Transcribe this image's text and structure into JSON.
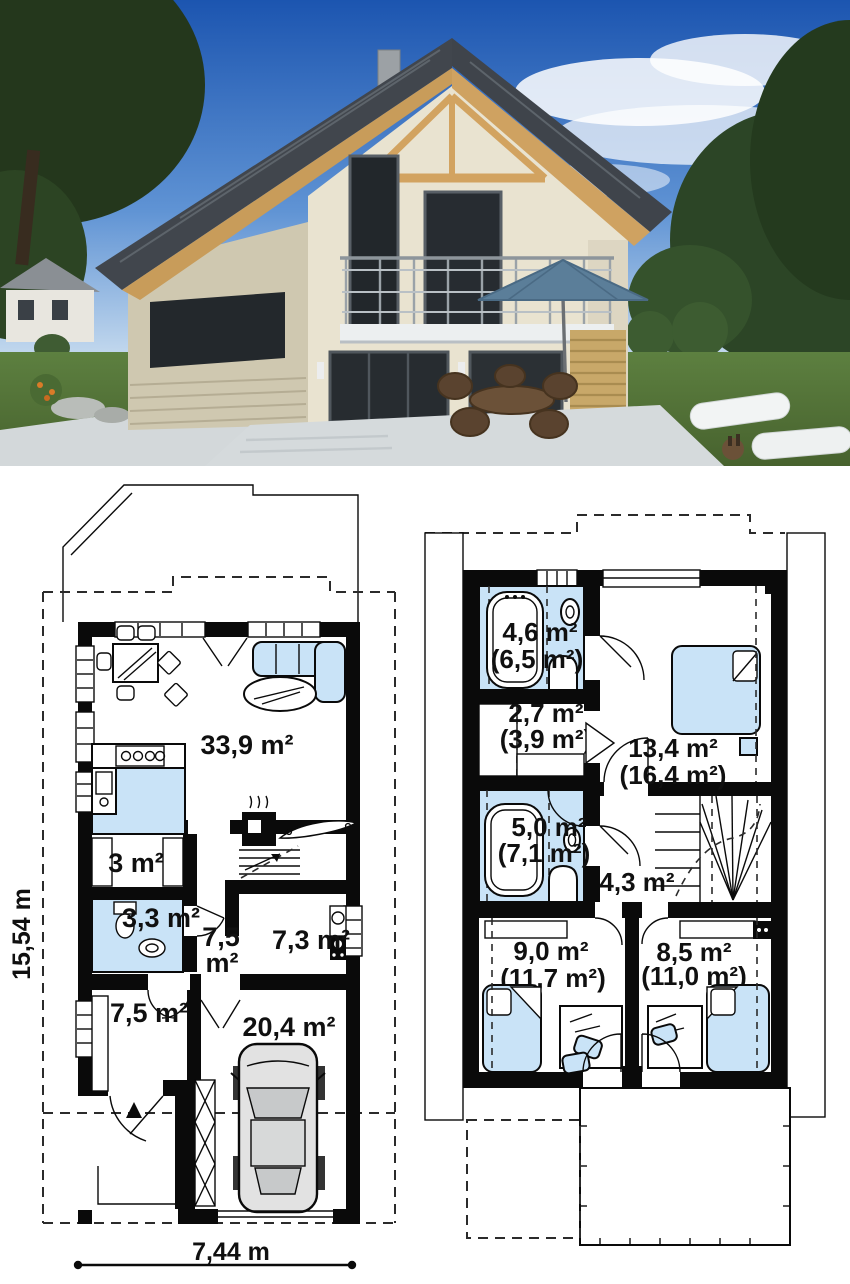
{
  "photo": {
    "colors": {
      "sky_top": "#1c55b0",
      "sky_horizon": "#c8dcef",
      "roof": "#41464d",
      "timber": "#cfa261",
      "wall_light": "#e9e3d0",
      "wall_shadow": "#cfc8b0",
      "lawn": "#5d8040",
      "umbrella": "#5b7e99",
      "patio": "#d5dadc"
    }
  },
  "ground_floor": {
    "dimension_vertical": "15,54 m",
    "dimension_horizontal": "7,44 m",
    "rooms": [
      {
        "id": "living-dining",
        "area": "33,9 m²"
      },
      {
        "id": "wardrobe",
        "area": "3 m²"
      },
      {
        "id": "bathroom",
        "area": "3,3 m²"
      },
      {
        "id": "hall",
        "area": "7,5 m²",
        "line1": "7,5",
        "line2": "m²"
      },
      {
        "id": "utility",
        "area": "7,3 m²"
      },
      {
        "id": "bedroom",
        "area": "7,5 m²"
      },
      {
        "id": "garage",
        "area": "20,4 m²"
      }
    ]
  },
  "upper_floor": {
    "rooms": [
      {
        "id": "bathroom-top",
        "area": "4,6 m²",
        "gross": "(6,5 m²)"
      },
      {
        "id": "wardrobe",
        "area": "2,7 m²",
        "gross": "(3,9 m²)"
      },
      {
        "id": "bedroom-right",
        "area": "13,4 m²",
        "gross": "(16,4 m²)"
      },
      {
        "id": "bathroom-mid",
        "area": "5,0 m²",
        "gross": "(7,1 m²)"
      },
      {
        "id": "hall-stairs",
        "area": "4,3 m²"
      },
      {
        "id": "bedroom-bottom-left",
        "area": "9,0 m²",
        "gross": "(11,7 m²)"
      },
      {
        "id": "bedroom-bottom-right",
        "area": "8,5 m²",
        "gross": "(11,0 m²)"
      }
    ]
  },
  "plan_colors": {
    "wall": "#0a0a0a",
    "room_fill": "#c9e3f7",
    "background": "#ffffff"
  }
}
